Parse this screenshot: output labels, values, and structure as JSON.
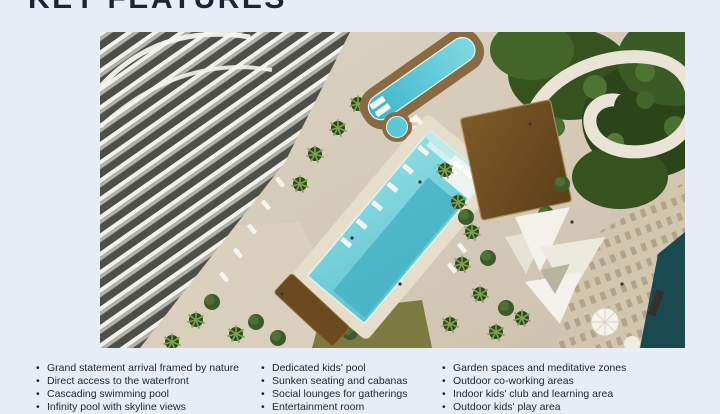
{
  "page": {
    "background_color": "#e8ecf6",
    "text_color": "#212735",
    "accent_dark": "#1d2433"
  },
  "header": {
    "title": "KEY FEATURES"
  },
  "hero": {
    "description": "Aerial rendering of a curved white residential tower with podium pools, cabanas, gardens, shade sails and a waterfront boardwalk",
    "palette": {
      "paving": "#d8cdbb",
      "pool_water": "#7fd6de",
      "deep_water": "#46b3c5",
      "sea": "#1a4a50",
      "greenery": "#3c5a2a",
      "cabana_roof": "#6f4c1f",
      "building_band": "#f2f1ed"
    }
  },
  "features": {
    "columns": [
      {
        "items": [
          "Grand statement arrival framed by nature",
          "Direct access to the waterfront",
          "Cascading swimming pool",
          "Infinity pool with skyline views"
        ]
      },
      {
        "items": [
          "Dedicated kids' pool",
          "Sunken seating and cabanas",
          "Social lounges for gatherings",
          "Entertainment room"
        ]
      },
      {
        "items": [
          "Garden spaces and meditative zones",
          "Outdoor co-working areas",
          "Indoor kids' club and learning area",
          "Outdoor kids' play area"
        ]
      }
    ]
  }
}
